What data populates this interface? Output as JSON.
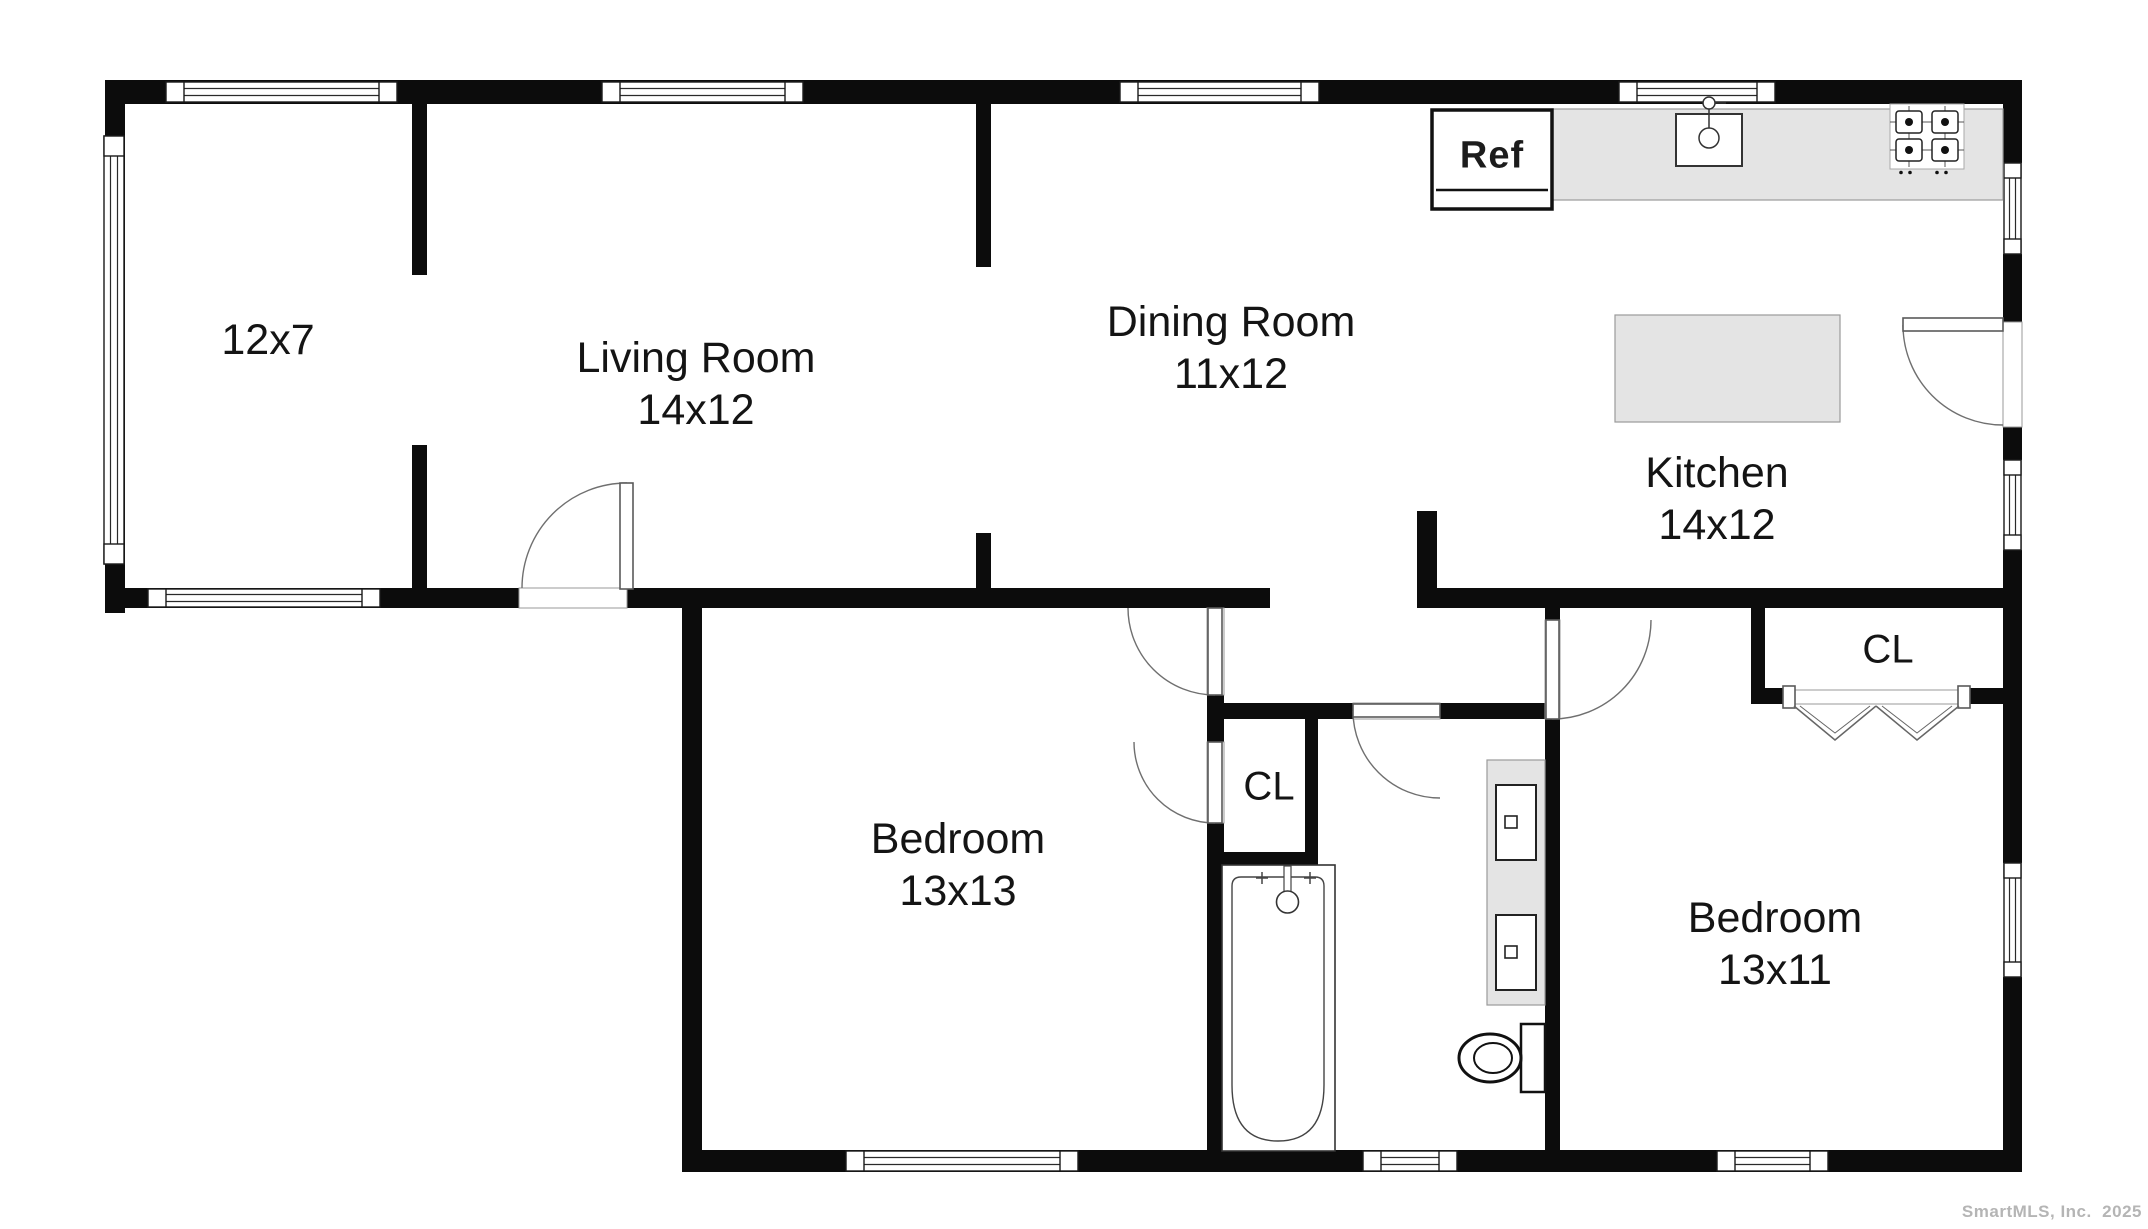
{
  "plan": {
    "rooms": [
      {
        "id": "room-12x7",
        "name": "",
        "dims": "12x7"
      },
      {
        "id": "living-room",
        "name": "Living Room",
        "dims": "14x12"
      },
      {
        "id": "dining-room",
        "name": "Dining Room",
        "dims": "11x12"
      },
      {
        "id": "kitchen",
        "name": "Kitchen",
        "dims": "14x12"
      },
      {
        "id": "bedroom-1",
        "name": "Bedroom",
        "dims": "13x13"
      },
      {
        "id": "bedroom-2",
        "name": "Bedroom",
        "dims": "13x11"
      }
    ],
    "closets": [
      {
        "label": "CL"
      },
      {
        "label": "CL"
      }
    ],
    "appliances": {
      "refrigerator_label": "Ref"
    },
    "fixture_icons": [
      "refrigerator",
      "kitchen-sink",
      "cooktop",
      "kitchen-island",
      "bathtub",
      "tub-faucet",
      "vanity-double-sink",
      "toilet",
      "bifold-closet-doors",
      "window",
      "door-swing"
    ],
    "watermark": "SmartMLS, Inc.  2025",
    "colors": {
      "wall": "#0c0c0c",
      "counter_fill": "#e4e4e4",
      "counter_border": "#9a9a9a",
      "text": "#141414",
      "watermark": "#b5b5b5",
      "background": "#ffffff"
    }
  }
}
